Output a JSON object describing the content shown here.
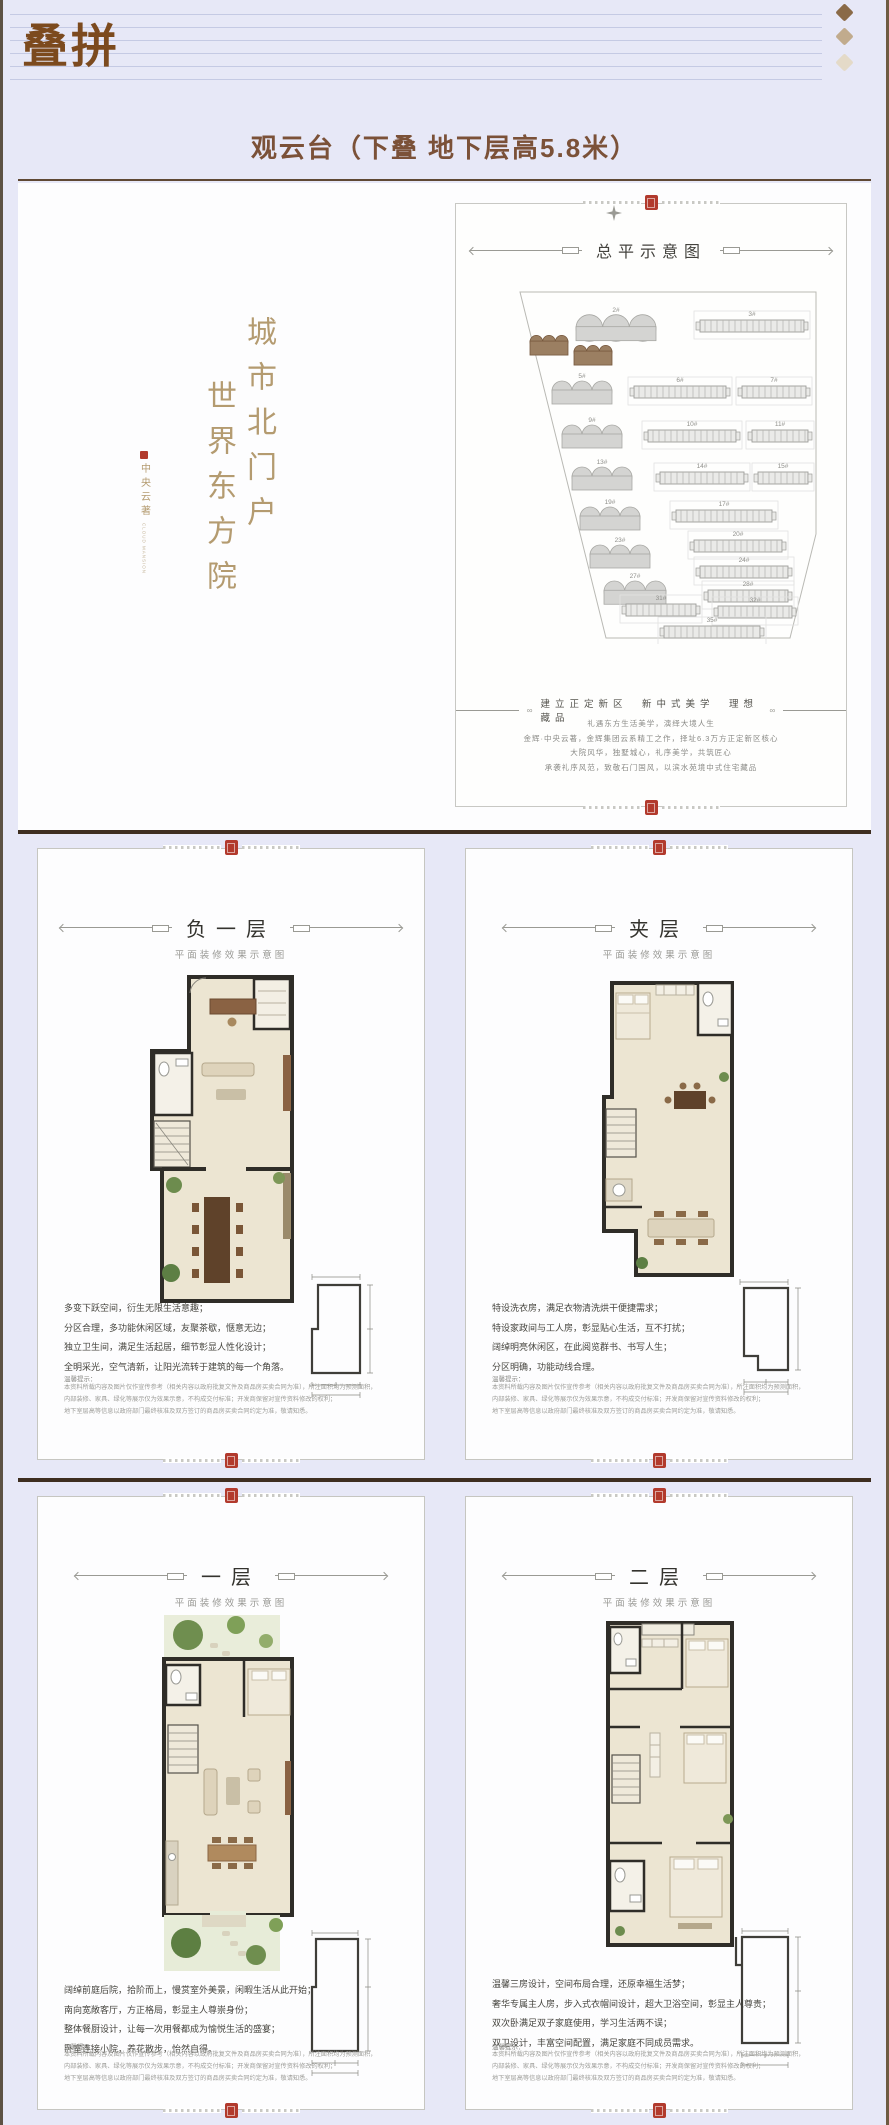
{
  "header": {
    "title": "叠拼"
  },
  "page_title": "观云台（下叠 地下层高5.8米）",
  "palette": {
    "accent_brown": "#7c4a1e",
    "seal_red": "#b23a2d",
    "gold": "#b49b70",
    "lavender": "#e7e8f7"
  },
  "intro": {
    "vertical_right": "城市北门户",
    "vertical_left": "世界东方院",
    "emblem_text": "中央云著",
    "emblem_caption": "CLOUD MANSION",
    "siteplan_title": "总平示意图",
    "ornament": "∞",
    "slogan": "建立正定新区　新中式美学　理想藏品",
    "paragraphs": [
      "礼遇东方生活美学，演绎大境人生",
      "金辉·中央云著，金辉集团云系精工之作，择址6.3万方正定新区核心",
      "大院风华，独墅城心，礼序美学，共筑匠心",
      "承袭礼序风范，致敬石门国风，以滨水苑境中式住宅藏品"
    ],
    "buildings": [
      {
        "k": "g",
        "x": 102,
        "y": 34,
        "w": 80,
        "label": "2#"
      },
      {
        "k": "s",
        "x": 226,
        "y": 38,
        "w": 104,
        "label": "3#"
      },
      {
        "k": "gh",
        "x": 56,
        "y": 54,
        "w": 38,
        "label": ""
      },
      {
        "k": "gh",
        "x": 100,
        "y": 64,
        "w": 38,
        "label": ""
      },
      {
        "k": "g",
        "x": 78,
        "y": 100,
        "w": 60,
        "label": "5#"
      },
      {
        "k": "s",
        "x": 160,
        "y": 104,
        "w": 92,
        "label": "6#"
      },
      {
        "k": "s",
        "x": 268,
        "y": 104,
        "w": 64,
        "label": "7#"
      },
      {
        "k": "g",
        "x": 88,
        "y": 144,
        "w": 60,
        "label": "9#"
      },
      {
        "k": "s",
        "x": 174,
        "y": 148,
        "w": 88,
        "label": "10#"
      },
      {
        "k": "s",
        "x": 278,
        "y": 148,
        "w": 56,
        "label": "11#"
      },
      {
        "k": "g",
        "x": 98,
        "y": 186,
        "w": 60,
        "label": "13#"
      },
      {
        "k": "s",
        "x": 186,
        "y": 190,
        "w": 84,
        "label": "14#"
      },
      {
        "k": "s",
        "x": 284,
        "y": 190,
        "w": 50,
        "label": "15#"
      },
      {
        "k": "g",
        "x": 106,
        "y": 226,
        "w": 60,
        "label": "19#"
      },
      {
        "k": "s",
        "x": 202,
        "y": 228,
        "w": 96,
        "label": "17#"
      },
      {
        "k": "g",
        "x": 116,
        "y": 264,
        "w": 60,
        "label": "23#"
      },
      {
        "k": "s",
        "x": 220,
        "y": 258,
        "w": 88,
        "label": "20#"
      },
      {
        "k": "s",
        "x": 226,
        "y": 284,
        "w": 88,
        "label": "24#"
      },
      {
        "k": "g",
        "x": 130,
        "y": 300,
        "w": 62,
        "label": "27#"
      },
      {
        "k": "s",
        "x": 234,
        "y": 308,
        "w": 80,
        "label": "28#"
      },
      {
        "k": "s",
        "x": 152,
        "y": 322,
        "w": 70,
        "label": "31#"
      },
      {
        "k": "s",
        "x": 244,
        "y": 324,
        "w": 74,
        "label": "32#"
      },
      {
        "k": "s",
        "x": 190,
        "y": 344,
        "w": 96,
        "label": "35#"
      }
    ]
  },
  "disclaimer_lines": [
    "本资料所载内容及图片仅作宣传参考（相关内容以政府批复文件及商品房买卖合同为准），所注面积均为预测面积，",
    "内部装修、家具、绿化等展示仅为效果示意，不构成交付标准；开发商保留对宣传资料修改的权利；",
    "地下室层高等信息以政府部门最终核准及双方签订的商品房买卖合同约定为准，敬请知悉。"
  ],
  "floors": [
    {
      "title": "负一层",
      "subtitle": "平面装修效果示意图",
      "note_label": "温馨提示：",
      "features": [
        "多变下跃空间，衍生无限生活意趣；",
        "分区合理，多功能休闲区域，友聚茶歇，惬意无边；",
        "独立卫生间，满足生活起居，细节彰显人性化设计；",
        "全明采光，空气清新，让阳光流转于建筑的每一个角落。"
      ]
    },
    {
      "title": "夹层",
      "subtitle": "平面装修效果示意图",
      "note_label": "温馨提示：",
      "features": [
        "特设洗衣房，满足衣物清洗烘干便捷需求；",
        "特设家政间与工人房，彰显贴心生活，互不打扰；",
        "阔绰明亮休闲区，在此阅览群书、书写人生；",
        "分区明确，功能动线合理。"
      ]
    },
    {
      "title": "一层",
      "subtitle": "平面装修效果示意图",
      "note_label": "温馨提示：",
      "features": [
        "阔绰前庭后院，拾阶而上，慢赏室外美景，闲暇生活从此开始；",
        "南向宽敞客厅，方正格局，彰显主人尊崇身份；",
        "整体餐厨设计，让每一次用餐都成为愉悦生活的盛宴；",
        "卧室连接小院，养花散步，怡然自得。"
      ]
    },
    {
      "title": "二层",
      "subtitle": "平面装修效果示意图",
      "note_label": "温馨提示：",
      "features": [
        "温馨三房设计，空间布局合理，还原幸福生活梦；",
        "奢华专属主人房，步入式衣帽间设计，超大卫浴空间，彰显主人尊贵；",
        "双次卧满足双子家庭使用，学习生活两不误；",
        "双卫设计，丰富空间配置，满足家庭不同成员需求。"
      ]
    }
  ]
}
